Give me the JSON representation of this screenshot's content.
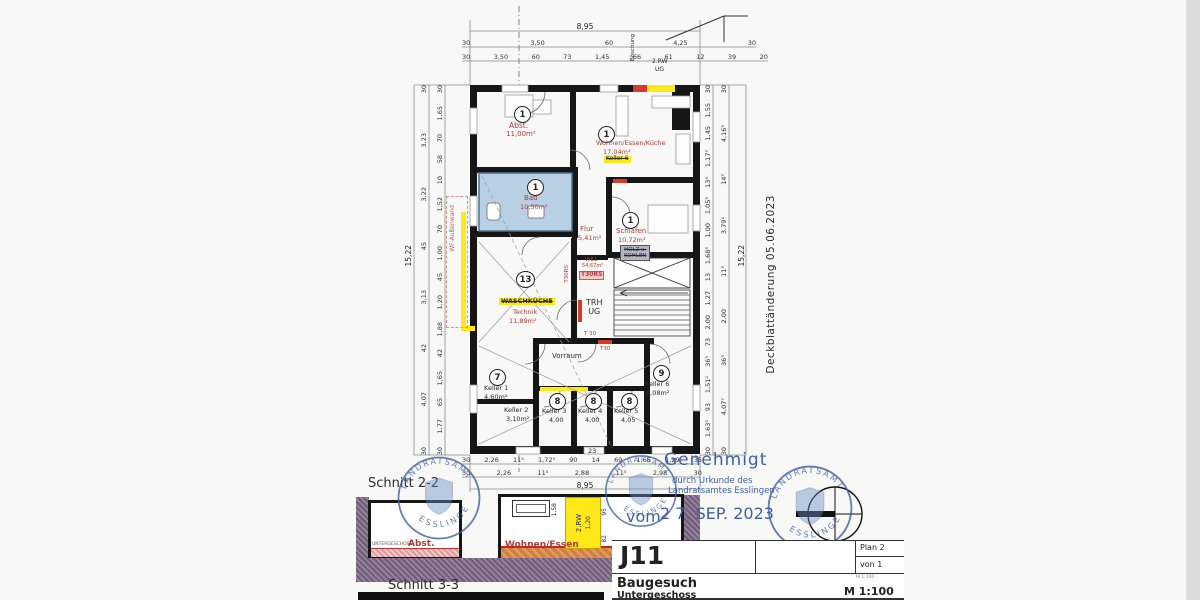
{
  "plan": {
    "rooms": {
      "abst": {
        "no": "1",
        "name": "Abst.",
        "area": "11,00m²"
      },
      "wohnen": {
        "no": "1",
        "name": "Wohnen/Essen/Küche",
        "area": "17,04m²",
        "note": "Keller 6"
      },
      "bad": {
        "no": "1",
        "name": "Bad",
        "area": "10,50m²"
      },
      "flur": {
        "name": "Flur",
        "area": "5,41m²"
      },
      "schlafen": {
        "no": "1",
        "name": "Schlafen",
        "area": "10,72m²",
        "note1": "HOLZ u.",
        "note2": "KOHLEN"
      },
      "we1": {
        "name": "WE1",
        "area": "54,67m²",
        "door": "T30RS"
      },
      "trh": {
        "line1": "TRH",
        "line2": "UG",
        "door": "T 30"
      },
      "wasch": {
        "no": "13",
        "name": "WASCHKÜCHE",
        "name2": "Technik",
        "area": "11,89m²"
      },
      "vorraum": {
        "name": "Vorraum",
        "door": "T30"
      },
      "keller1": {
        "no": "7",
        "name": "Keller 1",
        "area": "4,60m²"
      },
      "keller2": {
        "name": "Keller 2",
        "area": "3,10m²"
      },
      "keller3": {
        "no": "8",
        "name": "Keller 3",
        "area": "4,00"
      },
      "keller4": {
        "no": "8",
        "name": "Keller 4",
        "area": "4,00"
      },
      "keller5": {
        "no": "8",
        "name": "Keller 5",
        "area": "4,05"
      },
      "keller6": {
        "no": "9",
        "name": "Keller 6",
        "area": "6,08m²"
      }
    },
    "annotations": {
      "boeschung": "Böschung",
      "rw1": "2.RW",
      "rw2": "UG",
      "wf": "WF-Außenwand",
      "deckblatt": "Deckblattänderung 05.06.2023"
    },
    "dims": {
      "top_total": "8,95",
      "top_a": [
        "30",
        "3,50",
        "60",
        "4,25",
        "30"
      ],
      "top_b": [
        "30",
        "3,50",
        "60",
        "73",
        "1,45",
        "66",
        "61",
        "12",
        "39",
        "20"
      ],
      "bottom_small": "23",
      "bottom_a": [
        "30",
        "2,26",
        "11⁵",
        "1,72⁵",
        "90",
        "14",
        "69",
        "1,66",
        "1,29",
        "35"
      ],
      "bottom_b": [
        "30",
        "2,26",
        "11⁵",
        "2,88",
        "11⁵",
        "2,98",
        "30"
      ],
      "bottom_total": "8,95",
      "left_total": "15,22",
      "left_a": [
        "30",
        "1,65",
        "70",
        "58",
        "10",
        "1,52",
        "70",
        "1,00",
        "45",
        "1,20",
        "1,88",
        "42",
        "1,65",
        "65",
        "1,77",
        "30"
      ],
      "left_b": [
        "30",
        "3,23",
        "3,22",
        "45",
        "3,13",
        "42",
        "4,07",
        "30"
      ],
      "right_total": "15,22",
      "right_a": [
        "30",
        "1,55",
        "1,45",
        "1,17⁵",
        "13⁵",
        "1,05⁵",
        "1,00",
        "1,68⁵",
        "13",
        "1,27",
        "2,00",
        "73",
        "36⁵",
        "1,51²",
        "93",
        "1,63⁵",
        "30"
      ],
      "right_b": [
        "30",
        "4,16⁵",
        "14⁵",
        "3,79⁵",
        "11⁵",
        "2,00",
        "36⁵",
        "4,07⁷",
        "30"
      ]
    }
  },
  "sections": {
    "s22": {
      "title": "Schnitt 2-2",
      "floor": "UNTERGESCHOSS",
      "left": "Abst.",
      "right": "Wohnen/Essen",
      "rw": "2.RW",
      "rw_dim": "1,20",
      "d1": "1,58",
      "d2": "95",
      "d3": "82"
    },
    "s33": {
      "title": "Schnitt 3-3"
    }
  },
  "approval": {
    "l1": "Genehmigt",
    "l2": "durch Urkunde des",
    "l3": "Landratsamtes Esslingen",
    "vom": "vom",
    "date": "2 7. SEP. 2023"
  },
  "stamp": {
    "top": "LANDRATSAMT",
    "bottom": "ESSLINGEN"
  },
  "title_block": {
    "code": "J11",
    "plan": "Plan  2",
    "sheet": "von  1",
    "scale_small": "M 1:100 ·",
    "doc": "Baugesuch",
    "floor": "Untergeschoss",
    "scale": "M 1:100"
  }
}
